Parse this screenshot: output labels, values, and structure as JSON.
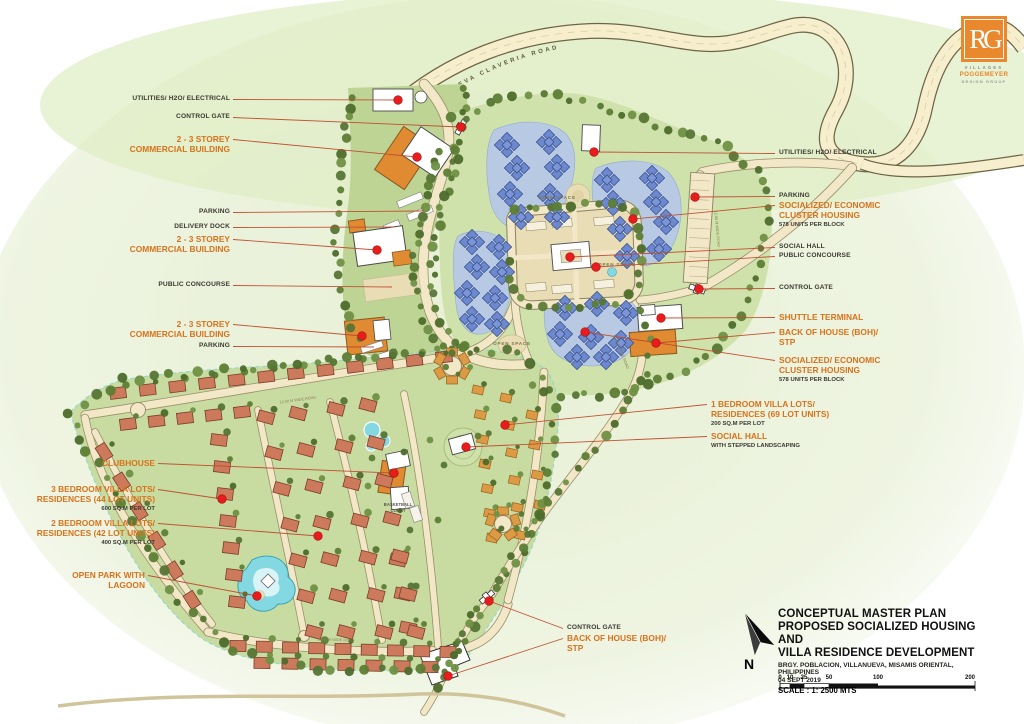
{
  "road_label": "VILLANUEVA CLAVERIA ROAD",
  "colors": {
    "accent_orange": "#d8731c",
    "marker_red": "#e81c1c",
    "road_cream": "#f6eecd",
    "cluster_blue": "#6d88cc",
    "villa_salmon": "#cd7a5c"
  },
  "logo": {
    "monogram": "RG",
    "line1": "VILLAGES",
    "line2": "POGGEMEYER",
    "line3": "DESIGN GROUP"
  },
  "title_block": {
    "title_line1": "CONCEPTUAL MASTER PLAN",
    "title_line2": "PROPOSED SOCIALIZED HOUSING AND",
    "title_line3": "VILLA RESIDENCE DEVELOPMENT",
    "address": "BRGY. POBLACION, VILLANUEVA, MISAMIS ORIENTAL, PHILIPPINES",
    "date": "04 SEPT 2019",
    "scale_text": "SCALE : 1: 2500 MTS",
    "scale_ticks": [
      "0",
      "10",
      "25",
      "50",
      "100",
      "200"
    ],
    "north_letter": "N"
  },
  "map_texts": {
    "open_space": "OPEN SPACE",
    "basketball_line1": "BASKETBALL",
    "basketball_line2": "COURT",
    "road_width": "12.00 M WIDE ROAD"
  },
  "labels": [
    {
      "id": "utilities-left",
      "style": "plain",
      "lines": [
        "UTILITIES/ H2O/ ELECTRICAL"
      ]
    },
    {
      "id": "control-gate-left",
      "style": "plain",
      "lines": [
        "CONTROL GATE"
      ]
    },
    {
      "id": "commercial-1",
      "style": "accent",
      "lines": [
        "2 - 3 STOREY",
        "COMMERCIAL BUILDING"
      ]
    },
    {
      "id": "parking-left-1",
      "style": "plain",
      "lines": [
        "PARKING"
      ]
    },
    {
      "id": "delivery-dock",
      "style": "plain",
      "lines": [
        "DELIVERY DOCK"
      ]
    },
    {
      "id": "commercial-2",
      "style": "accent",
      "lines": [
        "2 - 3 STOREY",
        "COMMERCIAL BUILDING"
      ]
    },
    {
      "id": "public-concourse-left",
      "style": "plain",
      "lines": [
        "PUBLIC CONCOURSE"
      ]
    },
    {
      "id": "commercial-3",
      "style": "accent",
      "lines": [
        "2 - 3 STOREY",
        "COMMERCIAL BUILDING"
      ]
    },
    {
      "id": "parking-left-2",
      "style": "plain",
      "lines": [
        "PARKING"
      ]
    },
    {
      "id": "clubhouse",
      "style": "accent",
      "lines": [
        "CLUBHOUSE"
      ]
    },
    {
      "id": "villa-3br",
      "style": "accent",
      "lines": [
        "3 BEDROOM VILLA LOTS/",
        "RESIDENCES (44 LOT UNITS)"
      ],
      "sub": "600 SQ.M PER LOT"
    },
    {
      "id": "villa-2br",
      "style": "accent",
      "lines": [
        "2 BEDROOM VILLA LOTS/",
        "RESIDENCES (42 LOT UNITS)"
      ],
      "sub": "400 SQ.M PER LOT"
    },
    {
      "id": "open-park",
      "style": "accent",
      "lines": [
        "OPEN PARK WITH",
        "LAGOON"
      ]
    },
    {
      "id": "utilities-right",
      "style": "plain",
      "lines": [
        "UTILITIES/ H2O/ ELECTRICAL"
      ]
    },
    {
      "id": "parking-right",
      "style": "plain",
      "lines": [
        "PARKING"
      ]
    },
    {
      "id": "cluster-housing-1",
      "style": "accent",
      "lines": [
        "SOCIALIZED/ ECONOMIC",
        "CLUSTER HOUSING"
      ],
      "sub": "578 UNITS PER BLOCK"
    },
    {
      "id": "social-hall-right",
      "style": "plain",
      "lines": [
        "SOCIAL HALL"
      ]
    },
    {
      "id": "public-concourse-right",
      "style": "plain",
      "lines": [
        "PUBLIC CONCOURSE"
      ]
    },
    {
      "id": "control-gate-right",
      "style": "plain",
      "lines": [
        "CONTROL GATE"
      ]
    },
    {
      "id": "shuttle-terminal",
      "style": "accent",
      "lines": [
        "SHUTTLE TERMINAL"
      ]
    },
    {
      "id": "boh-right",
      "style": "accent",
      "lines": [
        "BACK OF HOUSE (BOH)/",
        "STP"
      ]
    },
    {
      "id": "cluster-housing-2",
      "style": "accent",
      "lines": [
        "SOCIALIZED/ ECONOMIC",
        "CLUSTER HOUSING"
      ],
      "sub": "578 UNITS PER BLOCK"
    },
    {
      "id": "villa-1br",
      "style": "accent",
      "lines": [
        "1 BEDROOM VILLA LOTS/",
        "RESIDENCES (69 LOT UNITS)"
      ],
      "sub": "200 SQ.M PER LOT"
    },
    {
      "id": "social-hall-stepped",
      "style": "accent",
      "lines": [
        "SOCIAL HALL"
      ],
      "sub": "WITH STEPPED LANDSCAPING"
    },
    {
      "id": "control-gate-bottom",
      "style": "plain",
      "lines": [
        "CONTROL GATE"
      ]
    },
    {
      "id": "boh-bottom",
      "style": "accent",
      "lines": [
        "BACK OF HOUSE (BOH)/",
        "STP"
      ]
    }
  ]
}
